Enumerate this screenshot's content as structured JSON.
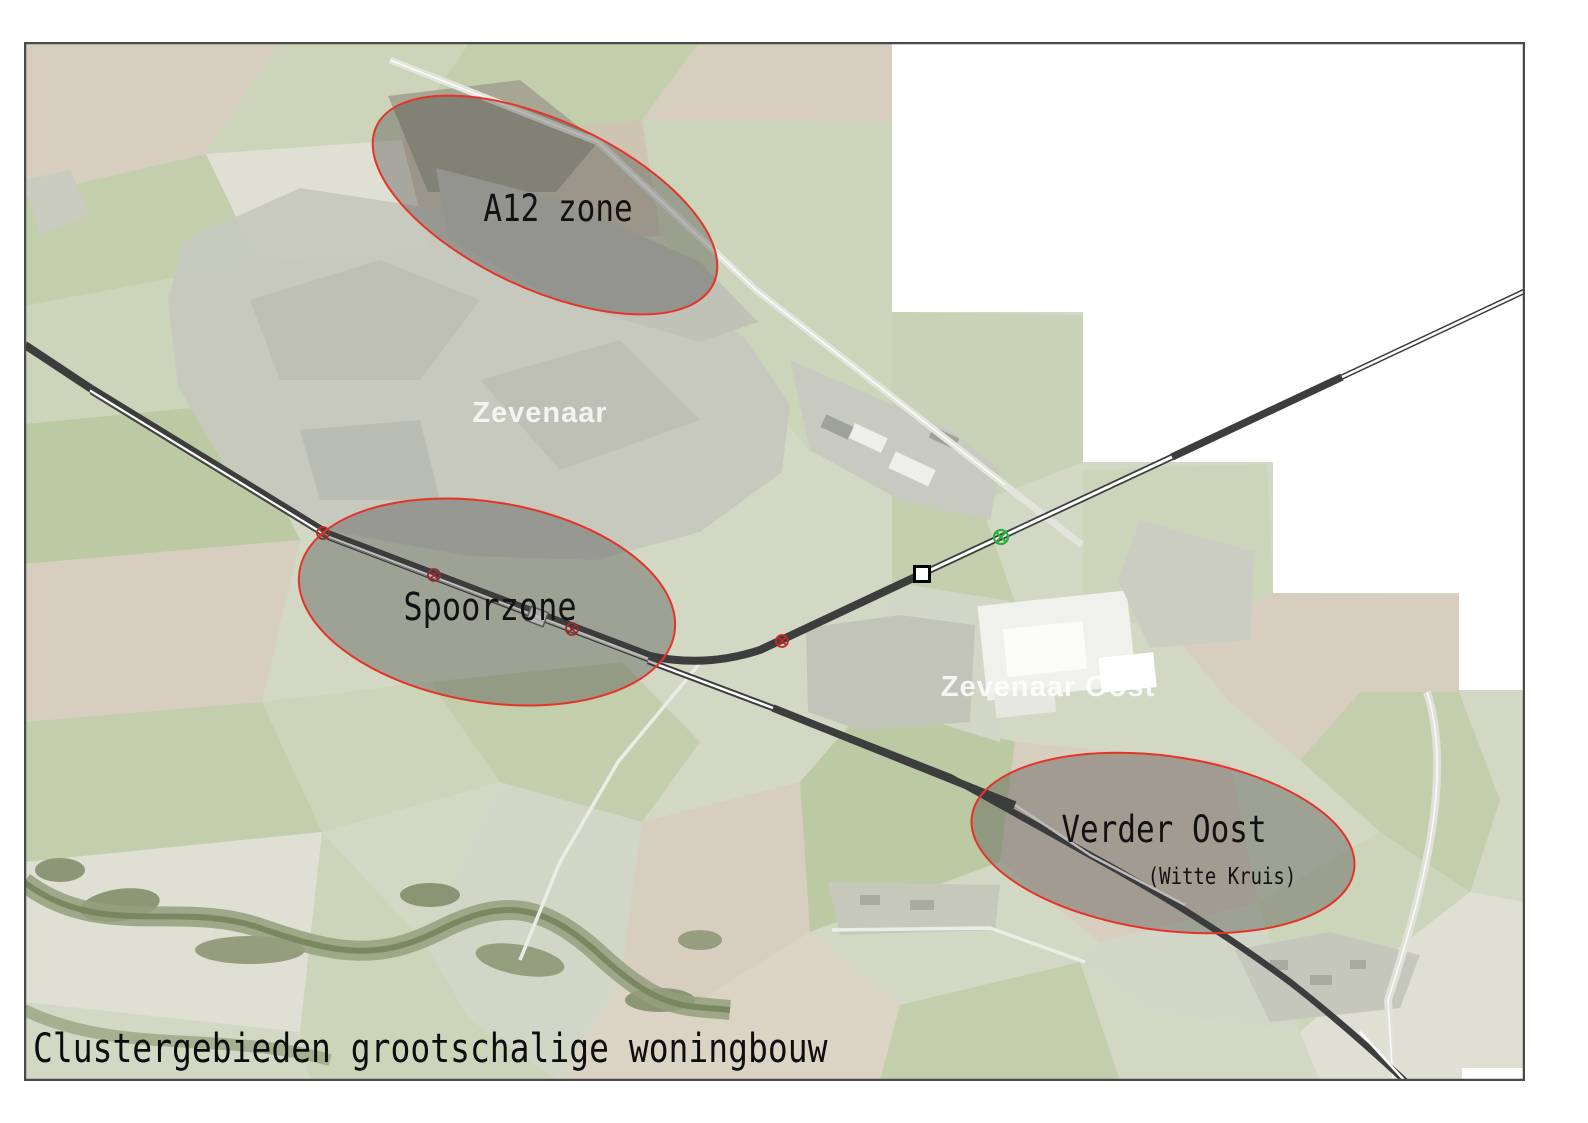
{
  "map": {
    "caption": "Clustergebieden grootschalige woningbouw",
    "zones": [
      {
        "id": "a12",
        "label": "A12 zone"
      },
      {
        "id": "spoorzone",
        "label": "Spoorzone"
      },
      {
        "id": "verder-oost",
        "label": "Verder Oost",
        "sublabel": "(Witte Kruis)"
      }
    ],
    "places": [
      {
        "name": "Zevenaar"
      },
      {
        "name": "Didam"
      },
      {
        "name": "Zevenaar Oost"
      }
    ],
    "colors": {
      "zone_outline": "#e63327",
      "zone_fill": "#3a3a3a",
      "railway": "#3d3d3d",
      "level_crossing": "#c02a28",
      "signal_green": "#2fae3e",
      "station_fill": "#ffffff",
      "frame": "#4a4a4a"
    }
  }
}
